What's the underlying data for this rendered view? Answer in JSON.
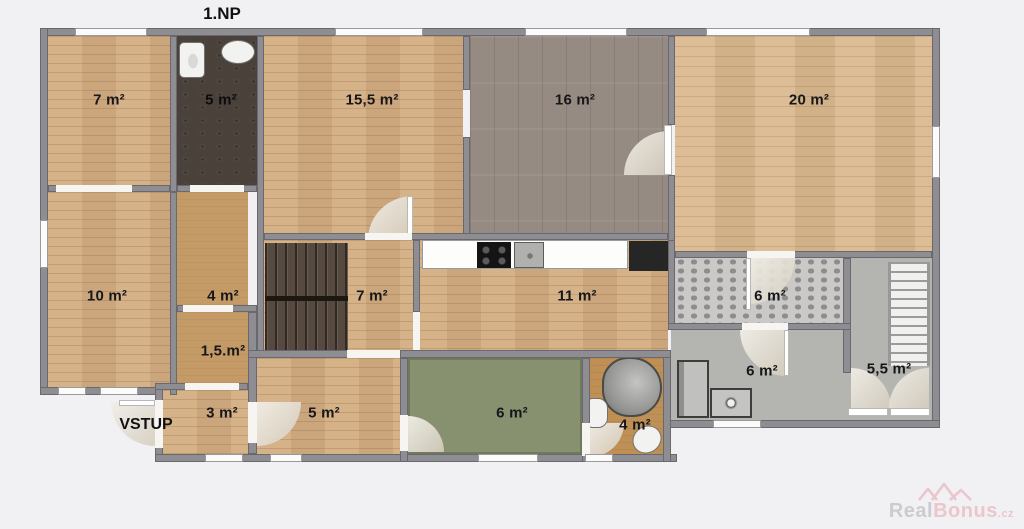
{
  "title": "1.NP",
  "entrance_label": "VSTUP",
  "rooms": [
    {
      "id": "room-7-top-left",
      "label": "7 m²"
    },
    {
      "id": "bathroom-5",
      "label": "5 m²"
    },
    {
      "id": "room-15-5",
      "label": "15,5 m²"
    },
    {
      "id": "room-16",
      "label": "16 m²"
    },
    {
      "id": "room-20",
      "label": "20 m²"
    },
    {
      "id": "room-10",
      "label": "10 m²"
    },
    {
      "id": "hall-4",
      "label": "4 m²"
    },
    {
      "id": "closet-1-5",
      "label": "1,5.m²"
    },
    {
      "id": "stair-hall-7",
      "label": "7 m²"
    },
    {
      "id": "kitchen-11",
      "label": "11 m²"
    },
    {
      "id": "hall-6-tiled",
      "label": "6 m²"
    },
    {
      "id": "utility-6",
      "label": "6 m²"
    },
    {
      "id": "stairwell-5-5",
      "label": "5,5 m²"
    },
    {
      "id": "entry-3",
      "label": "3 m²"
    },
    {
      "id": "corridor-5",
      "label": "5 m²"
    },
    {
      "id": "garden-room-6",
      "label": "6 m²"
    },
    {
      "id": "bathroom-4",
      "label": "4 m²"
    }
  ],
  "watermark": {
    "brand_gray": "Real",
    "brand_pink": "Bonus",
    "tld": ".cz"
  },
  "palette": {
    "background": "#f1f1f4",
    "wall": "#8d8d92",
    "wood_floor": "#d3ad82",
    "wood_floor_light": "#d9b88e",
    "gray_wood_floor": "#968b83",
    "dark_bath_floor": "#49413a",
    "tan_floor": "#c49a66",
    "orange_bath_floor": "#bf9055",
    "green_floor": "#87906f",
    "gray_floor": "#b4b4b0",
    "tile_dot": "#8e8d8b",
    "stairs_dark": "#564940",
    "label_text": "#17171a",
    "watermark_gray": "#c6c6ca",
    "watermark_pink": "#eabfc5"
  }
}
